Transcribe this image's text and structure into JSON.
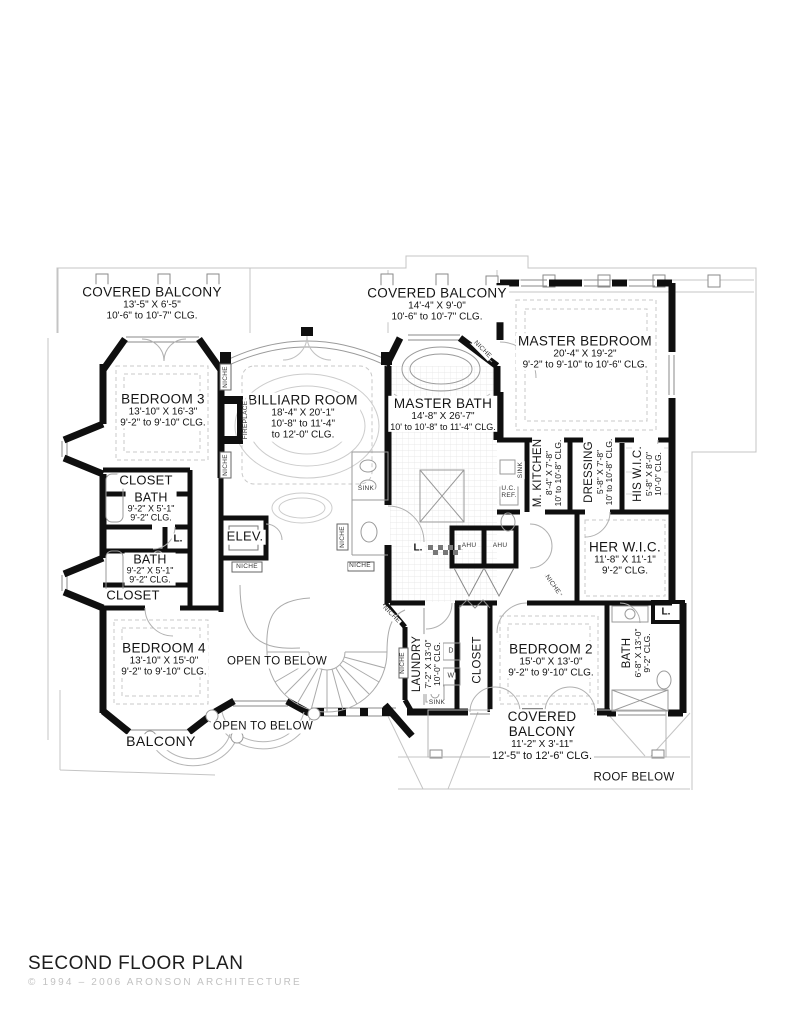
{
  "page": {
    "title": "SECOND FLOOR PLAN",
    "copyright": "© 1994 – 2006 ARONSON ARCHITECTURE"
  },
  "rooms": [
    {
      "id": "covered-balcony-top-left",
      "name": "COVERED BALCONY",
      "dims": "13'-5\" X 6'-5\"",
      "clg": "10'-6\" to 10'-7\" CLG."
    },
    {
      "id": "covered-balcony-top-center",
      "name": "COVERED BALCONY",
      "dims": "14'-4\" X 9'-0\"",
      "clg": "10'-6\" to 10'-7\" CLG."
    },
    {
      "id": "master-bedroom",
      "name": "MASTER BEDROOM",
      "dims": "20'-4\" X 19'-2\"",
      "clg": "9'-2\" to 9'-10\" to 10'-6\" CLG."
    },
    {
      "id": "bedroom-3",
      "name": "BEDROOM 3",
      "dims": "13'-10\" X 16'-3\"",
      "clg": "9'-2\" to 9'-10\" CLG."
    },
    {
      "id": "billiard-room",
      "name": "BILLIARD ROOM",
      "dims": "18'-4\" X 20'-1\"",
      "clg": "10'-8\" to 11'-4\"",
      "clg2": "to 12'-0\" CLG."
    },
    {
      "id": "master-bath",
      "name": "MASTER BATH",
      "dims": "14'-8\" X 26'-7\"",
      "clg": "10' to 10'-8\" to 11'-4\" CLG."
    },
    {
      "id": "closet-upper",
      "name": "CLOSET"
    },
    {
      "id": "bath-upper",
      "name": "BATH",
      "dims": "9'-2\" X 5'-1\"",
      "clg": "9'-2\" CLG."
    },
    {
      "id": "bath-lower",
      "name": "BATH",
      "dims": "9'-2\" X 5'-1\"",
      "clg": "9'-2\" CLG."
    },
    {
      "id": "closet-lower",
      "name": "CLOSET"
    },
    {
      "id": "elevator",
      "name": "ELEV."
    },
    {
      "id": "m-kitchen",
      "name": "M. KITCHEN",
      "dims": "8'-4\" X 7'-8\"",
      "clg": "10' to 10'-8\" CLG."
    },
    {
      "id": "dressing",
      "name": "DRESSING",
      "dims": "5'-8\" X 7'-8\"",
      "clg": "10' to 10'-8\" CLG."
    },
    {
      "id": "his-wic",
      "name": "HIS W.I.C.",
      "dims": "5'-8\" X 8'-0\"",
      "clg": "10'-0\" CLG."
    },
    {
      "id": "her-wic",
      "name": "HER W.I.C.",
      "dims": "11'-8\" X 11'-1\"",
      "clg": "9'-2\" CLG."
    },
    {
      "id": "bedroom-4",
      "name": "BEDROOM 4",
      "dims": "13'-10\" X 15'-0\"",
      "clg": "9'-2\" to 9'-10\" CLG."
    },
    {
      "id": "open-to-below-upper",
      "name": "OPEN TO BELOW"
    },
    {
      "id": "open-to-below-lower",
      "name": "OPEN TO BELOW"
    },
    {
      "id": "balcony",
      "name": "BALCONY"
    },
    {
      "id": "laundry",
      "name": "LAUNDRY",
      "dims": "7'-2\" X 13'-0\"",
      "clg": "10'-0\" CLG."
    },
    {
      "id": "closet-bedroom2",
      "name": "CLOSET"
    },
    {
      "id": "bedroom-2",
      "name": "BEDROOM 2",
      "dims": "15'-0\" X 13'-0\"",
      "clg": "9'-2\" to 9'-10\" CLG."
    },
    {
      "id": "bath-bedroom2",
      "name": "BATH",
      "dims": "6'-8\" X 13'-0\"",
      "clg": "9'-2\" CLG."
    },
    {
      "id": "covered-balcony-bottom",
      "name": "COVERED",
      "name2": "BALCONY",
      "dims": "11'-2\" X 3'-11\"",
      "clg": "12'-5\" to 12'-6\" CLG."
    },
    {
      "id": "roof-below",
      "name": "ROOF BELOW"
    }
  ],
  "annotations": {
    "linen": "L.",
    "ahu": "AHU",
    "sink": "SINK",
    "niche": "NICHE",
    "fireplace": "FIREPLACE",
    "uc_ref_line1": "U.C.",
    "uc_ref_line2": "REF.",
    "washer": "W",
    "dryer": "D"
  },
  "colors": {
    "wall": "#0f0f0f",
    "detail_light": "#c4c4c4",
    "detail_mid": "#9a9a9a",
    "text": "#141414",
    "copyright": "#c2c2c2"
  }
}
